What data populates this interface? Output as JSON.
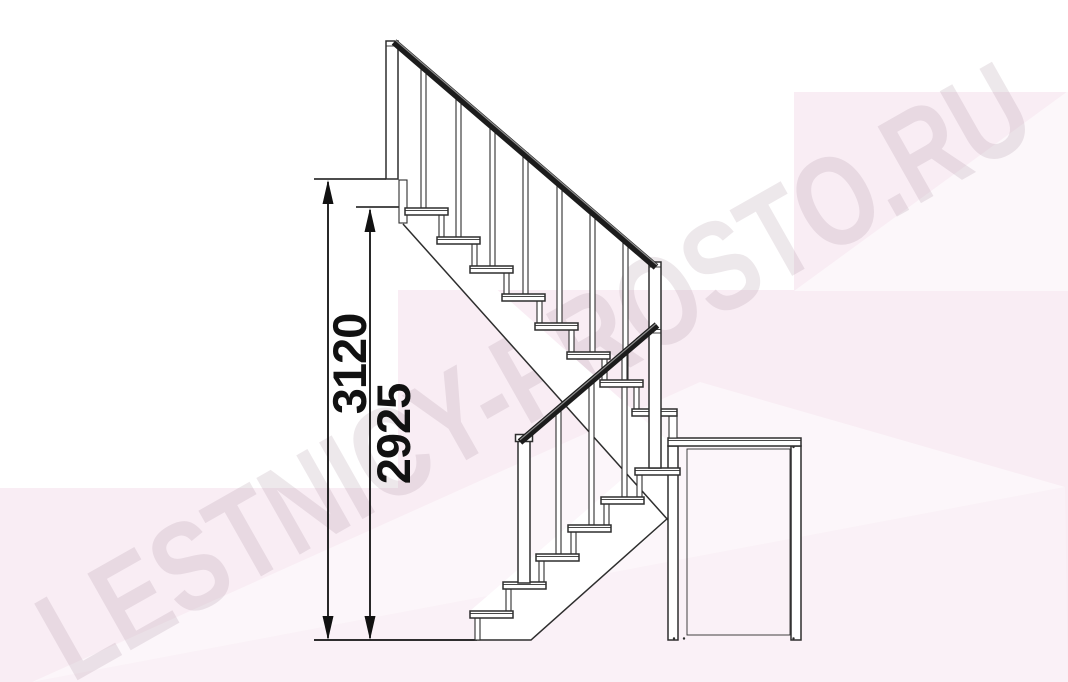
{
  "watermark": {
    "text": "LESTNICY-PROSTO.RU"
  },
  "drawing": {
    "type": "staircase-side-elevation",
    "dimensions": [
      {
        "label": "3120",
        "orientation": "vertical",
        "meaning": "overall height to upper floor"
      },
      {
        "label": "2925",
        "orientation": "vertical",
        "meaning": "height to top step"
      }
    ],
    "colors": {
      "line": "#2e2e2e",
      "handrail": "#1c1c1c",
      "dimension_text": "#111111",
      "background_pink": "#f9edf4",
      "watermark": "#a78a9d"
    }
  }
}
